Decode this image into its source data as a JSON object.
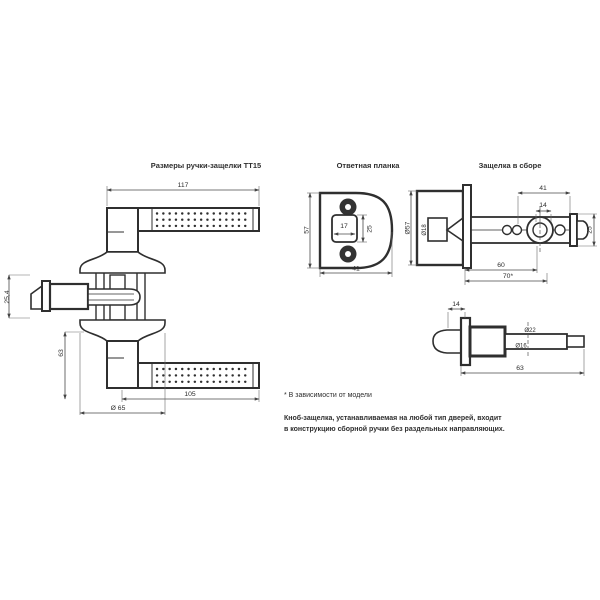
{
  "colors": {
    "ink": "#2f2f2f",
    "dim": "#4a4a4a",
    "background": "#ffffff"
  },
  "titles": {
    "main": "Размеры ручки-защелки ТТ15",
    "strike": "Ответная планка",
    "assembly": "Защелка в сборе"
  },
  "dims": {
    "main": {
      "lever_length": "117",
      "height": "63",
      "grip_length": "105",
      "rose_diameter": "Ø 65",
      "latch_case": "25,4"
    },
    "strike": {
      "plate_height": "57",
      "cutout_width": "17",
      "cutout_height": "25",
      "plate_width": "41"
    },
    "assembly": {
      "hub_length": "41",
      "spindle": "14",
      "knob_diameter": "Ø57",
      "stem_diameter": "Ø18",
      "faceplate_width": "25",
      "backset_1": "60",
      "backset_2": "70*"
    },
    "latch": {
      "bolt_throw": "14",
      "total_length": "63",
      "tube_upper": "Ø22",
      "tube_lower": "Ø16"
    }
  },
  "notes": {
    "asterisk": "* В зависимости от модели",
    "line1": "Кноб-защелка, устанавливаемая на любой тип дверей, входит",
    "line2": "в конструкцию сборной ручки без раздельных направляющих."
  }
}
